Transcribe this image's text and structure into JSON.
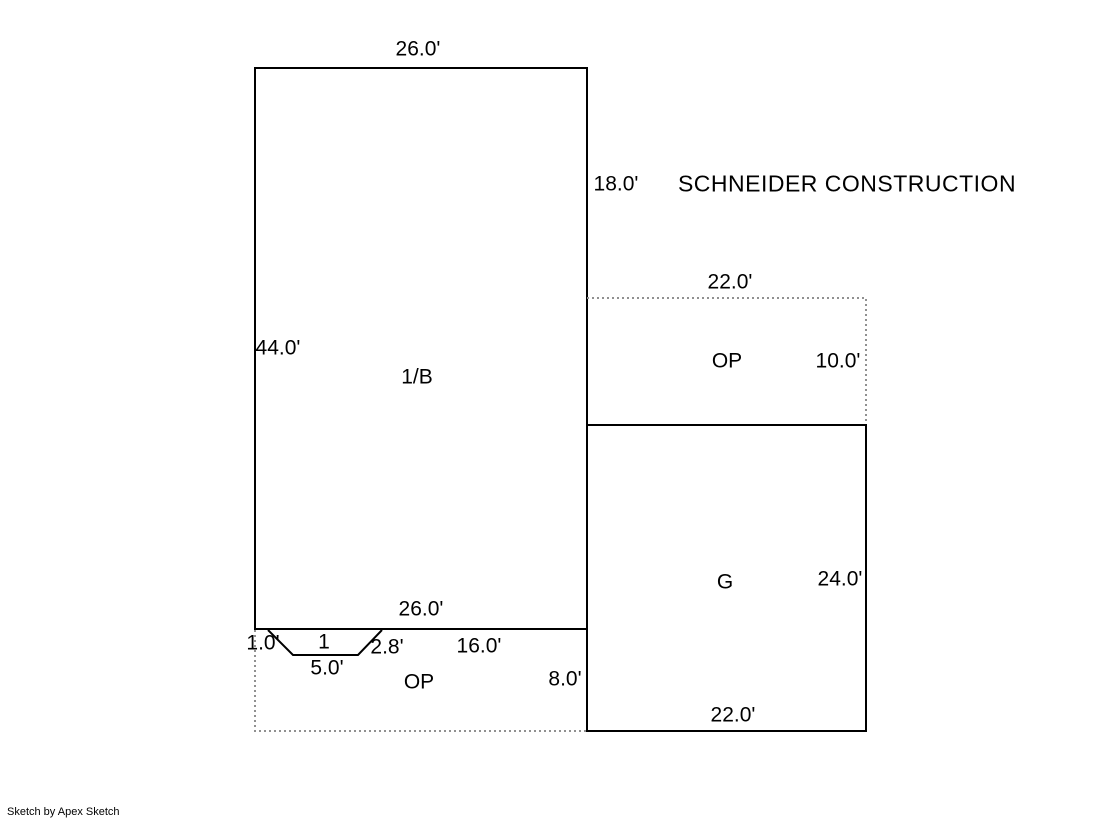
{
  "canvas": {
    "width": 1119,
    "height": 821,
    "background": "#ffffff"
  },
  "colors": {
    "solid_line": "#000000",
    "dashed_line": "#909090",
    "text": "#000000"
  },
  "company": "SCHNEIDER CONSTRUCTION",
  "watermark": "Sketch by Apex Sketch",
  "areas": {
    "main_building": {
      "label": "1/B",
      "top_width": "26.0'",
      "right_upper_height": "18.0'",
      "left_height": "44.0'",
      "bottom_width": "26.0'"
    },
    "open_porch_upper": {
      "label": "OP",
      "top_width": "22.0'",
      "right_height": "10.0'"
    },
    "garage": {
      "label": "G",
      "right_height": "24.0'",
      "bottom_width": "22.0'"
    },
    "open_porch_lower": {
      "label": "OP",
      "notch_offset": "1.0'",
      "notch_number": "1",
      "notch_slant": "2.8'",
      "notch_bottom": "5.0'",
      "bottom_segment": "16.0'",
      "right_height": "8.0'"
    }
  }
}
